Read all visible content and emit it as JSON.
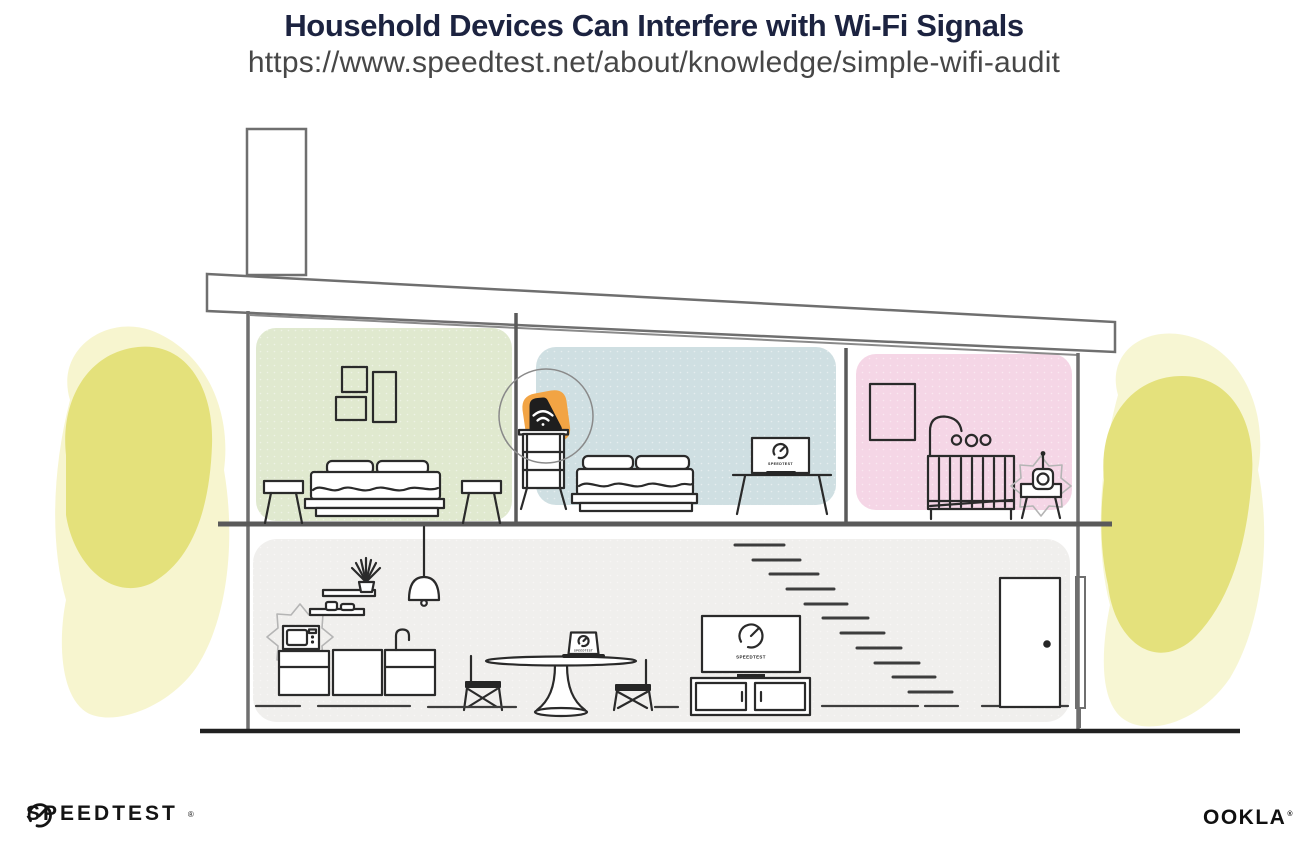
{
  "header": {
    "title": "Household Devices Can Interfere with Wi-Fi Signals",
    "url": "https://www.speedtest.net/about/knowledge/simple-wifi-audit"
  },
  "screens": {
    "bedroom_laptop_label": "SPEEDTEST",
    "dining_laptop_label": "SPEEDTEST",
    "tv_label": "SPEEDTEST"
  },
  "branding": {
    "speedtest_wordmark": "SPEEDTEST",
    "speedtest_mark": "®",
    "ookla_wordmark": "OOKLA",
    "ookla_mark": "®"
  },
  "palette": {
    "title_ink": "#1c2340",
    "url_gray": "#474747",
    "bedroom_green": "#e0e9cf",
    "bedroom_blue": "#cfdfe2",
    "nursery_pink": "#f5d6e6",
    "living_gray": "#f0efed",
    "tree_yellow": "#e2de74",
    "tree_yellow_light": "#f0eda8",
    "router_orange": "#f2a444",
    "structure_gray": "#6f6f6f",
    "ink": "#262626"
  }
}
